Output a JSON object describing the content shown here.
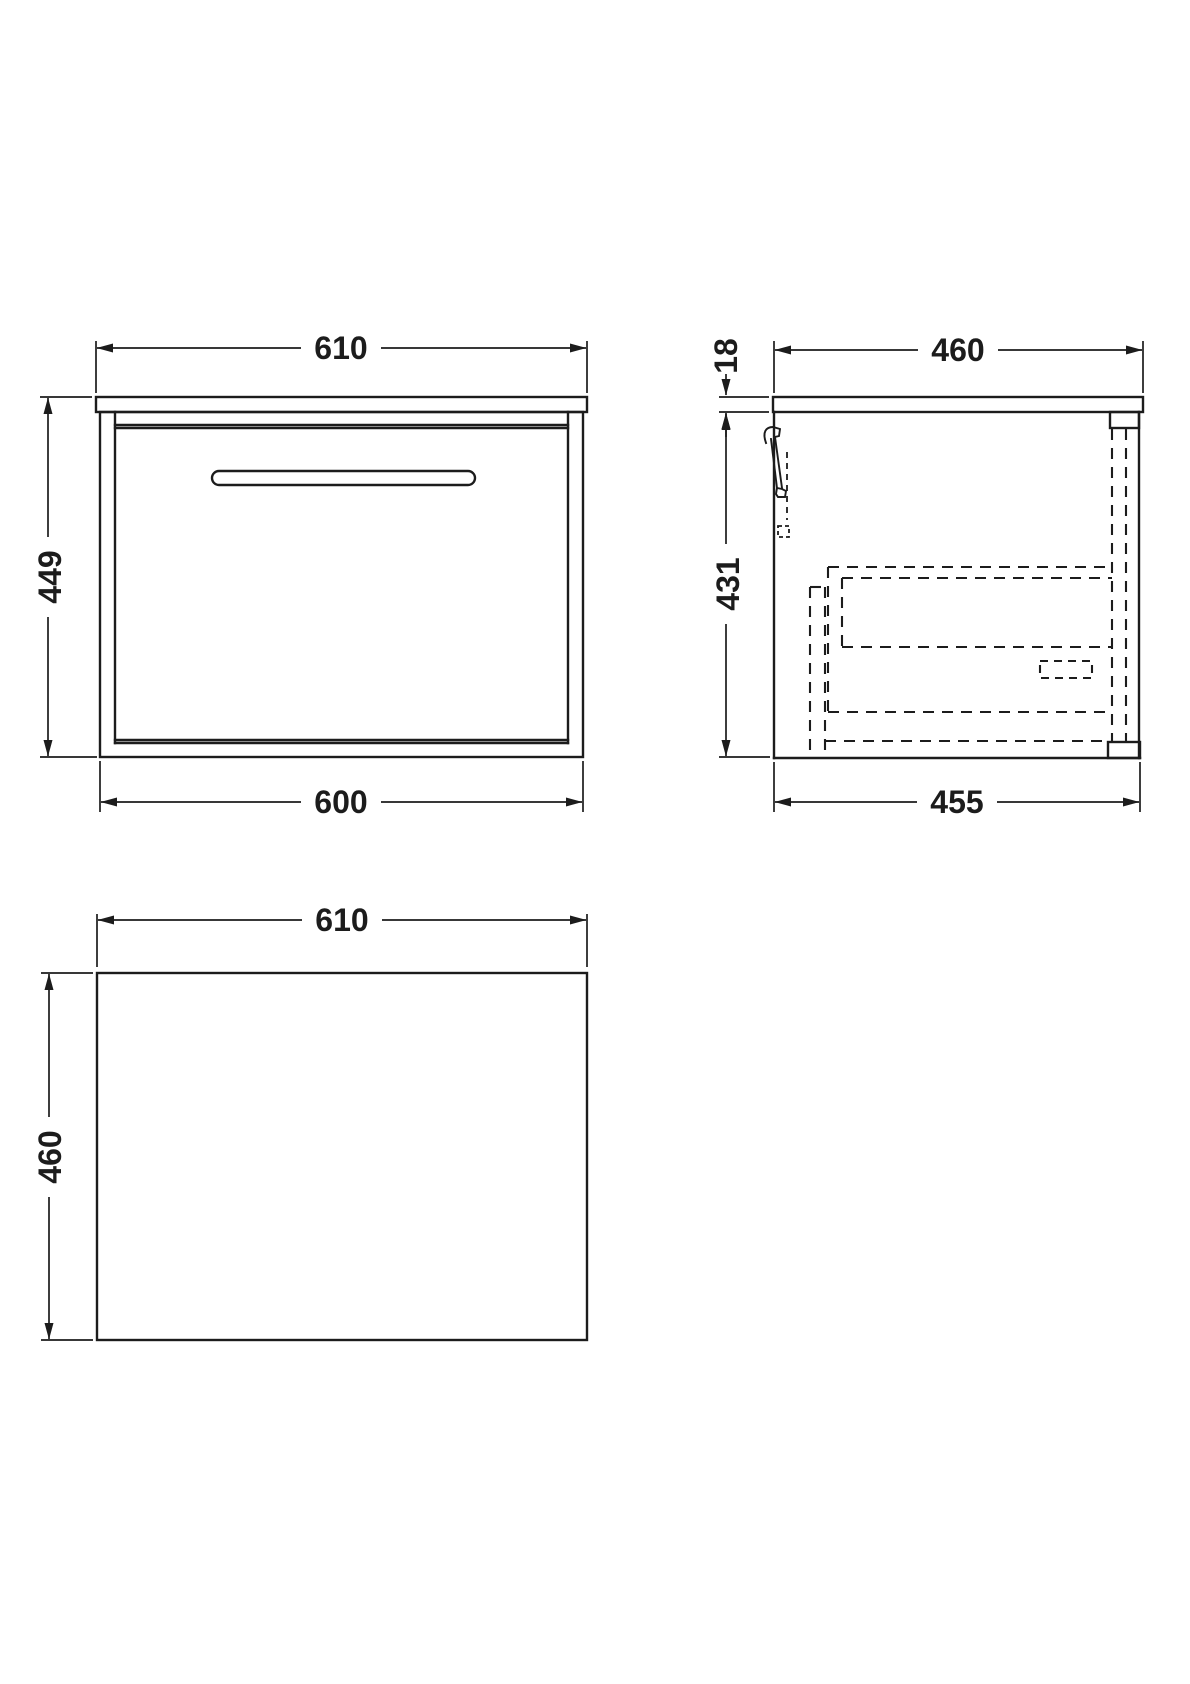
{
  "page": {
    "background": "#ffffff",
    "line_color": "#1c1c1c"
  },
  "views": {
    "front": {
      "dims": {
        "width_top": "610",
        "height_left": "449",
        "width_bottom": "600"
      }
    },
    "side": {
      "dims": {
        "depth_top": "460",
        "worktop_thickness": "18",
        "height_left": "431",
        "depth_bottom": "455"
      }
    },
    "plan": {
      "dims": {
        "width_top": "610",
        "depth_left": "460"
      }
    }
  }
}
